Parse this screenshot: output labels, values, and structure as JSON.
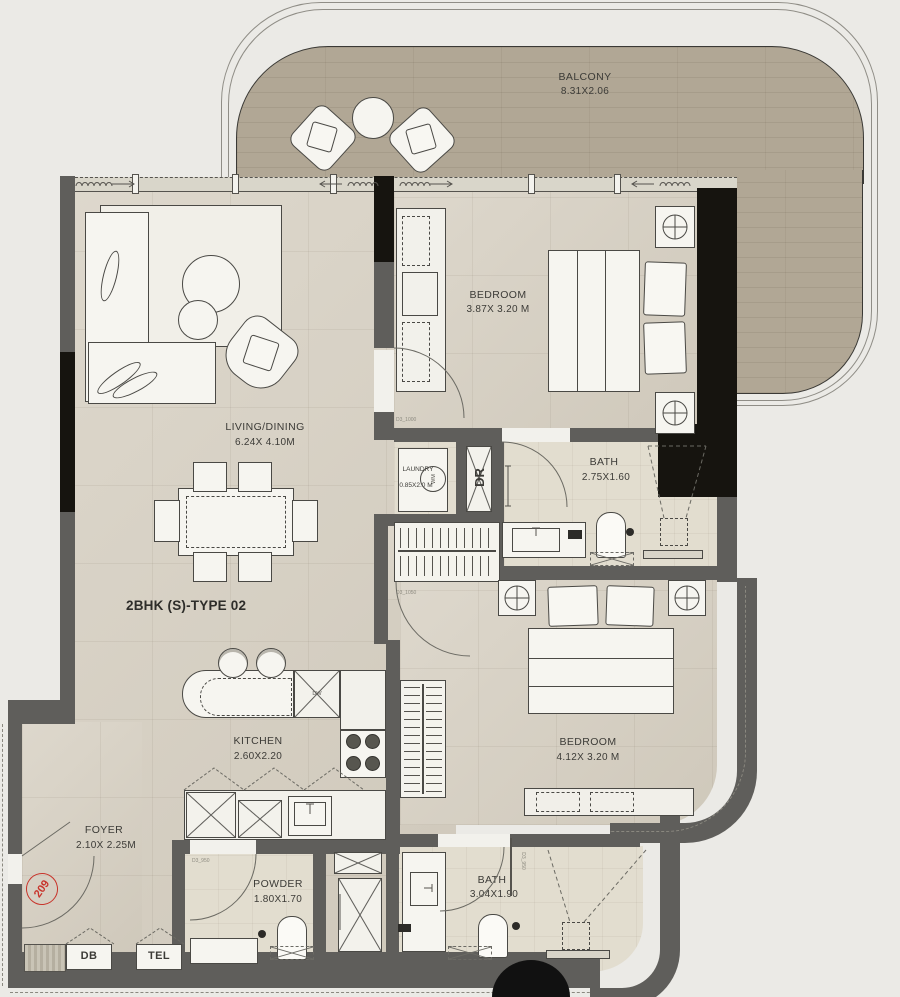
{
  "plan": {
    "unit_number": "209",
    "type_label": "2BHK (S)-TYPE 02"
  },
  "rooms": {
    "balcony": {
      "name": "BALCONY",
      "dims": "8.31X2.06"
    },
    "bedroom1": {
      "name": "BEDROOM",
      "dims": "3.87X 3.20 M"
    },
    "living": {
      "name": "LIVING/DINING",
      "dims": "6.24X 4.10M"
    },
    "laundry": {
      "name": "LAUNDRY",
      "dims": "0.85X2.0 M"
    },
    "bath1": {
      "name": "BATH",
      "dims": "2.75X1.60"
    },
    "bedroom2": {
      "name": "BEDROOM",
      "dims": "4.12X 3.20 M"
    },
    "kitchen": {
      "name": "KITCHEN",
      "dims": "2.60X2.20"
    },
    "foyer": {
      "name": "FOYER",
      "dims": "2.10X 2.25M"
    },
    "powder": {
      "name": "POWDER",
      "dims": "1.80X1.70"
    },
    "bath2": {
      "name": "BATH",
      "dims": "3.04X1.90"
    }
  },
  "labels": {
    "dr_shaft": "DR",
    "db_box": "DB",
    "tel_box": "TEL",
    "dishwasher": "DW",
    "washer": "WM"
  },
  "door_tags": {
    "bedroom1": "D3_1000",
    "bedroom2": "D3_1050",
    "powder": "D3_950",
    "bath2": "D3_950"
  },
  "colors": {
    "wall": "#5f5e5b",
    "wall_dark": "#16140f",
    "balcony_floor": "#b1a795",
    "interior_floor": "#d6cfc1",
    "bath_floor": "#e2ddcf",
    "unit_accent": "#c8342b"
  }
}
